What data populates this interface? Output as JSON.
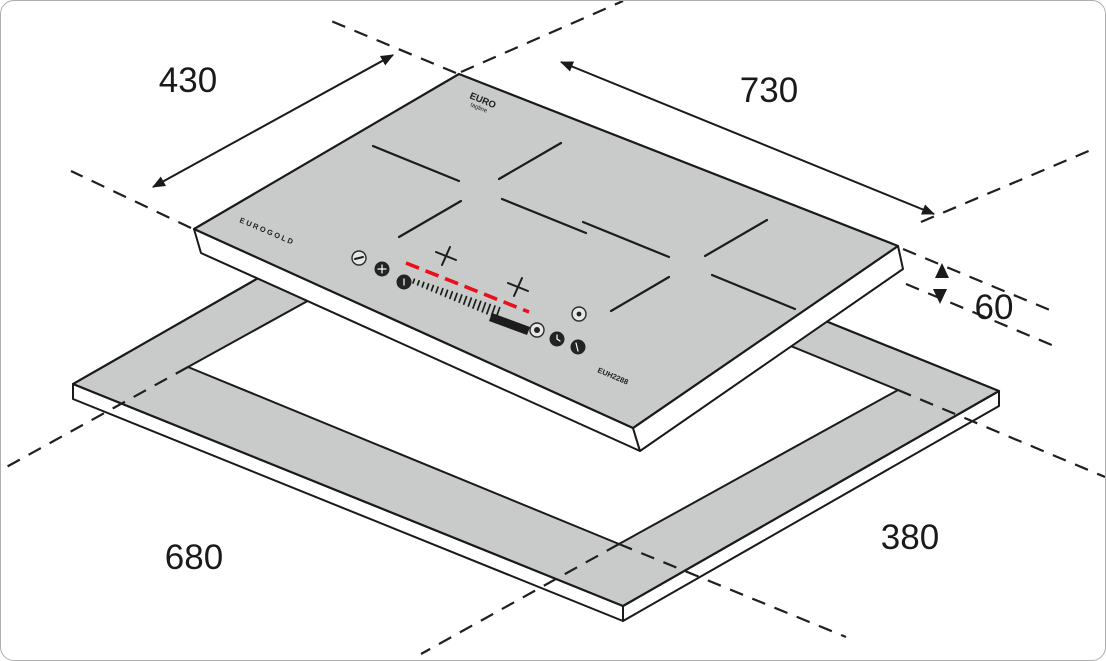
{
  "labels": {
    "dim_top_depth": "430",
    "dim_top_width": "730",
    "dim_thickness": "60",
    "dim_cutout_length": "680",
    "dim_cutout_depth": "380"
  },
  "branding": {
    "logo_primary": "EURO",
    "logo_secondary": "tagline",
    "edge_brand": "EUROGOLD",
    "model_number": "EUH2288"
  },
  "control_icons": [
    "minus-icon",
    "plus-icon",
    "lock-icon",
    "power-icon",
    "select-icon",
    "timer-icon",
    "boost-icon"
  ],
  "colors": {
    "surface_gray": "#c9cbca",
    "line_black": "#1a1a1a",
    "slider_accent": "#e8111b"
  }
}
